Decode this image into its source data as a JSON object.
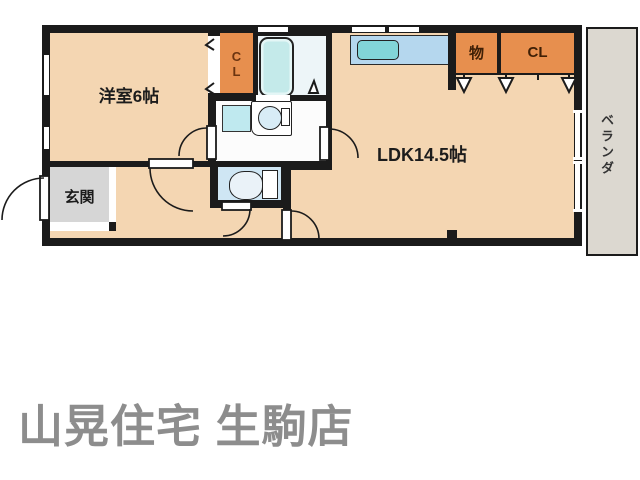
{
  "colors": {
    "wall": "#1b1b1b",
    "room_peach": "#f4d6b2",
    "closet_orange": "#e78f4e",
    "closet_text": "#6b3410",
    "water_blue": "#cfe6f4",
    "tub_blue": "#c4eaea",
    "bath_floor": "#edf5f8",
    "pan_blue": "#bfe9ef",
    "counter_blue": "#b5d7ee",
    "sink_teal": "#82d5d8",
    "genkan_gray": "#d6d6d6",
    "veranda_gray": "#dcd8d0",
    "footer_gray": "#8d8d8d"
  },
  "floorplan": {
    "rooms": {
      "western_room": {
        "label": "洋室6帖"
      },
      "ldk": {
        "label": "LDK14.5帖"
      },
      "entrance": {
        "label": "玄関"
      },
      "balcony": {
        "label": "ベランダ"
      },
      "closet_bedroom": {
        "label": "CL"
      },
      "storage": {
        "label": "物"
      },
      "closet_ldk": {
        "label": "CL"
      }
    }
  },
  "footer": {
    "shop_name": "山晃住宅 生駒店"
  }
}
